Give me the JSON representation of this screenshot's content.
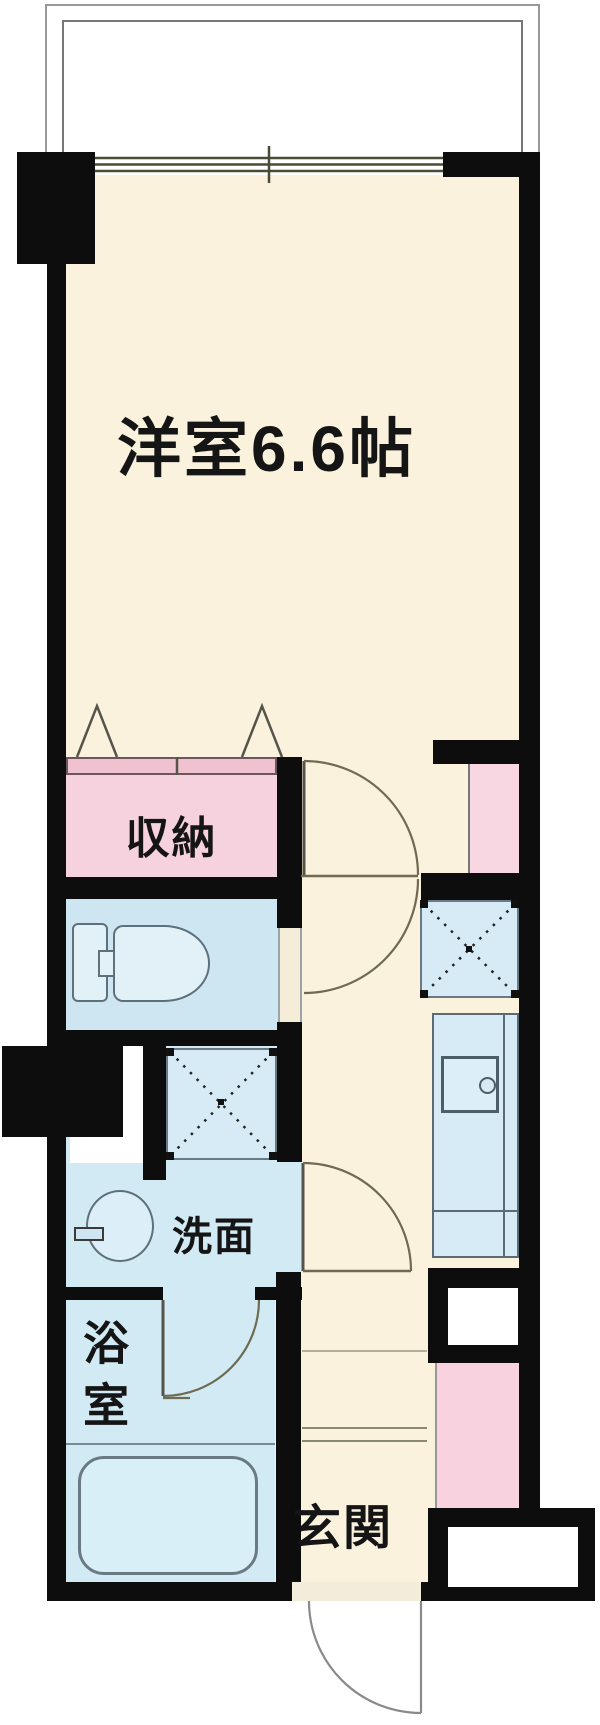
{
  "title": "apartment-floor-plan",
  "labels": {
    "main_room": "洋室6.6帖",
    "storage": "収納",
    "washroom": "洗面",
    "bathroom": "浴室",
    "entrance": "玄関"
  },
  "colors": {
    "wall_black": "#0d0d0d",
    "room_cream": "#FBF2DD",
    "wet_room_blue": "#D2EAF3",
    "toilet_room_blue": "#CDE6F1",
    "fixture_blue": "#E2F1F8",
    "counter_blue": "#D6EBF5",
    "storage_pink": "#F6D2DE",
    "storage_track_pink": "#F0C2CF",
    "pipe_space_pink": "#F8D7E2",
    "entrance_cabinet_pink": "#F8D3DF",
    "balcony_white": "#FFFFFF",
    "door_line_olive": "#6e6b52"
  },
  "symbols": [
    "balcony",
    "double-sliding-window",
    "folding-closet-door-triangles",
    "hinged-door-swing-arcs",
    "washer-placement-x-square",
    "kitchen-counter-with-sink",
    "toilet-fixture",
    "wash-basin-oval",
    "bathtub",
    "entrance-door-swing",
    "entrance-step-lines"
  ]
}
